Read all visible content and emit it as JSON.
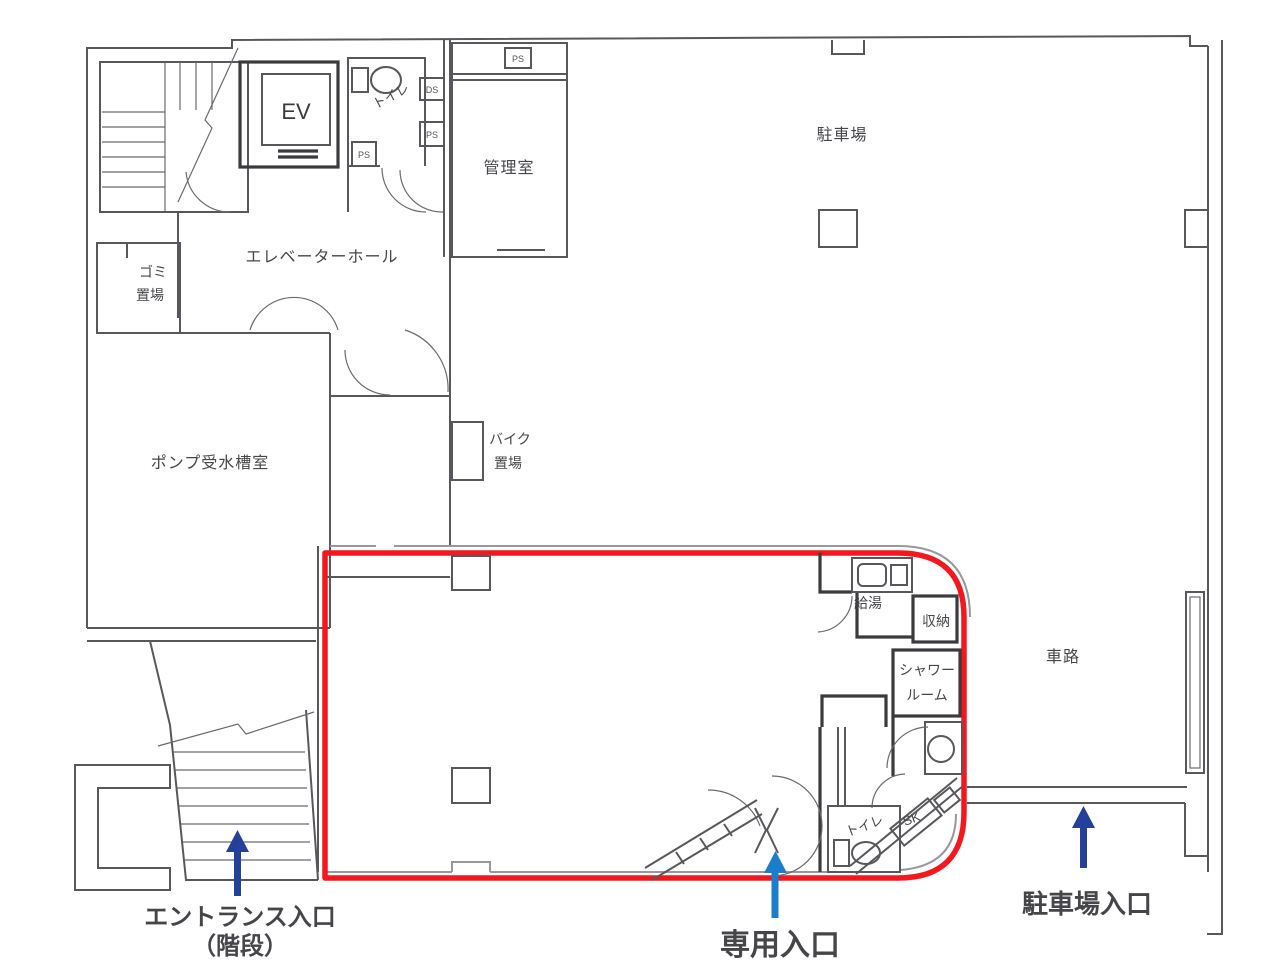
{
  "colors": {
    "wall": "#58585c",
    "leased_outline": "#f2181d",
    "label_text": "#46464a",
    "dark_blue": "#24409a",
    "bright_blue": "#1b7ecb"
  },
  "rooms": {
    "ev": "EV",
    "toilet_upper": "トイレ",
    "ds": "DS",
    "ps": "PS",
    "admin_room": "管理室",
    "parking": "駐車場",
    "elevator_hall": "エレベーターホール",
    "garbage_line1": "ゴミ",
    "garbage_line2": "置場",
    "pump_room": "ポンプ受水槽室",
    "bike_line1": "バイク",
    "bike_line2": "置場",
    "hot_water": "給湯",
    "storage": "収納",
    "shower_line1": "シャワー",
    "shower_line2": "ルーム",
    "sk": "SK",
    "toilet_lower": "トイレ",
    "driveway": "車路"
  },
  "annotations": {
    "entrance_line1": "エントランス入口",
    "entrance_line2": "（階段）",
    "private_entrance": "専用入口",
    "parking_entrance": "駐車場入口"
  }
}
